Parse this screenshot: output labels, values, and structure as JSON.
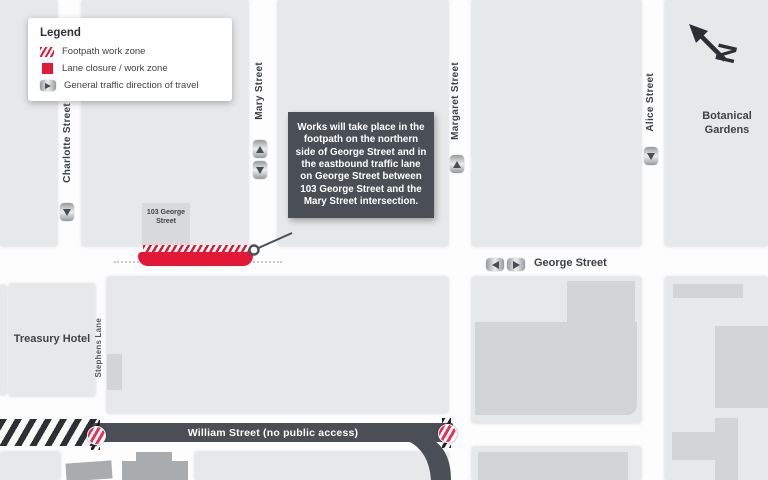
{
  "map_title": "Roadworks notification map",
  "legend": {
    "title": "Legend",
    "items": [
      {
        "icon": "footpath-hatch-icon",
        "label": "Footpath work zone"
      },
      {
        "icon": "lane-closure-icon",
        "label": "Lane closure / work zone"
      },
      {
        "icon": "traffic-direction-icon",
        "label": "General traffic direction of travel"
      }
    ]
  },
  "callout": {
    "text": "Works will take place in the footpath on the northern side of George Street and in the eastbound traffic lane on George Street between 103 George Street and the Mary Street intersection."
  },
  "streets": {
    "charlotte": {
      "label": "Charlotte Street",
      "direction": "southbound"
    },
    "mary": {
      "label": "Mary Street",
      "direction": "two-way"
    },
    "margaret": {
      "label": "Margaret Street",
      "direction": "northbound"
    },
    "alice": {
      "label": "Alice Street",
      "direction": "southbound"
    },
    "george": {
      "label": "George Street",
      "direction": "two-way"
    },
    "william": {
      "label": "William Street (no public access)"
    },
    "stephens_lane": {
      "label": "Stephens Lane"
    }
  },
  "places": {
    "treasury_hotel": "Treasury Hotel",
    "botanical_gardens": "Botanical Gardens",
    "building_103": "103 George Street"
  },
  "north_arrow": {
    "label": "N"
  },
  "colors": {
    "work_zone_red": "#e31837",
    "closure_dark": "#4a4f55",
    "block_gray": "#e7e8e9",
    "building_gray": "#d2d4d5",
    "dark_building_gray": "#a9acae",
    "no_entry_stripe": "#e8305a"
  }
}
